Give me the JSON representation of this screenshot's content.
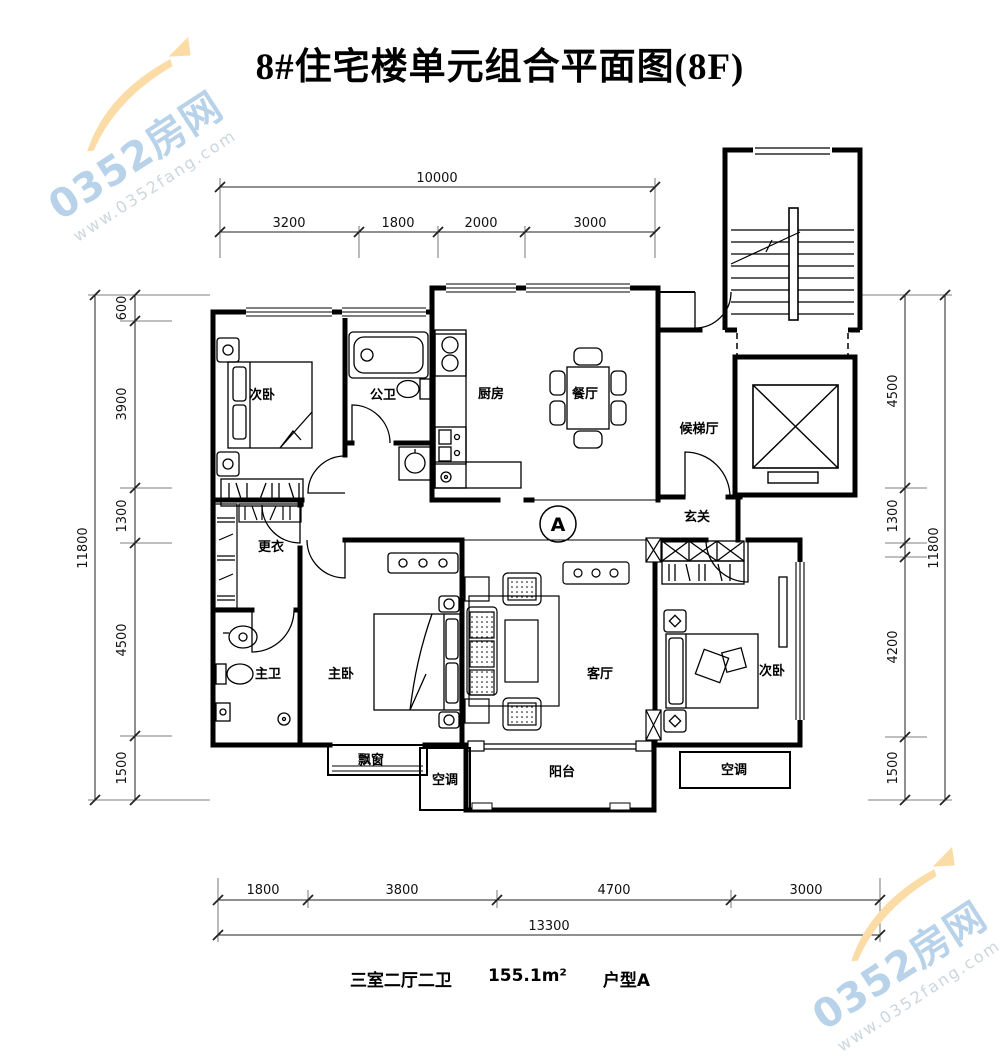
{
  "title": "8#住宅楼单元组合平面图(8F)",
  "plan_marker": "A",
  "rooms": {
    "bedroom_top_left": "次卧",
    "bath_public": "公卫",
    "kitchen": "厨房",
    "dining": "餐厅",
    "elevator_hall": "候梯厅",
    "foyer": "玄关",
    "dressing": "更衣",
    "bath_master": "主卫",
    "bedroom_master": "主卧",
    "living": "客厅",
    "bedroom_right": "次卧",
    "bay_window": "飘窗",
    "ac_left": "空调",
    "balcony": "阳台",
    "ac_right": "空调"
  },
  "dims": {
    "top": {
      "total": "10000",
      "segments": [
        "3200",
        "1800",
        "2000",
        "3000"
      ]
    },
    "left": {
      "total": "11800",
      "segments": [
        "600",
        "3900",
        "1300",
        "4500",
        "1500"
      ]
    },
    "right": {
      "total": "11800",
      "segments": [
        "4500",
        "1300",
        "4200",
        "1500"
      ]
    },
    "bottom": {
      "total": "13300",
      "segments": [
        "1800",
        "3800",
        "4700",
        "3000"
      ]
    }
  },
  "caption": {
    "layout": "三室二厅二卫",
    "area": "155.1m²",
    "type": "户型A"
  },
  "watermark": {
    "brand": "0352房网",
    "url": "www.0352fang.com"
  },
  "colors": {
    "wall": "#000000",
    "dim_line": "#222222",
    "watermark_blue": "#b4d0e8",
    "watermark_orange": "#fcdca6"
  }
}
